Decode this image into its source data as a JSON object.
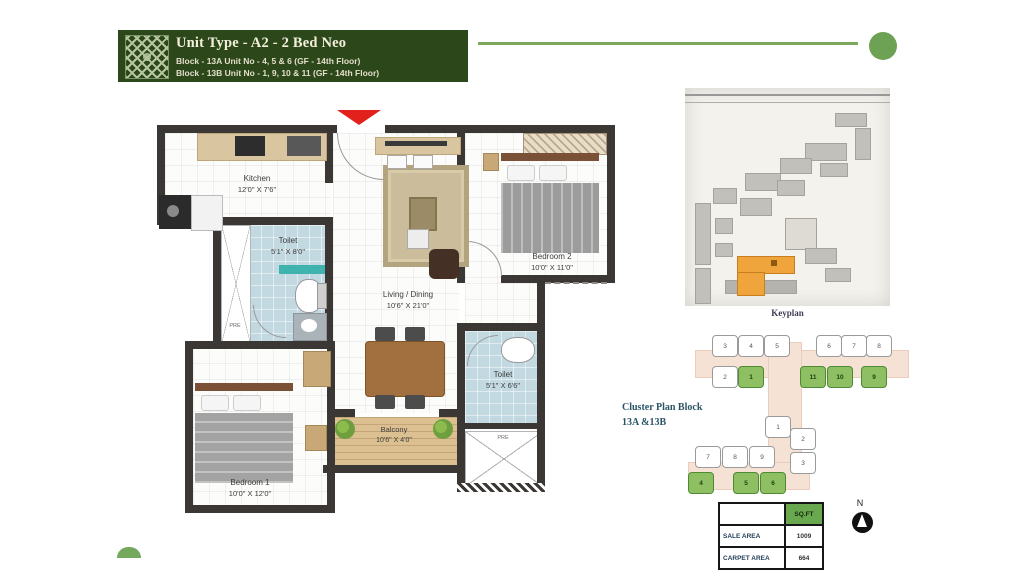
{
  "header": {
    "title": "Unit Type - A2 - 2 Bed Neo",
    "block_line1": "Block - 13A Unit No - 4, 5 & 6 (GF - 14th Floor)",
    "block_line2": "Block - 13B Unit No - 1, 9, 10 & 11 (GF - 14th Floor)"
  },
  "floorplan": {
    "kitchen": {
      "name": "Kitchen",
      "dims": "12'0\" X 7'6\""
    },
    "toilet1": {
      "name": "Toilet",
      "dims": "5'1\" X 8'0\""
    },
    "living": {
      "name": "Living / Dining",
      "dims": "10'6\" X 21'0\""
    },
    "bedroom2": {
      "name": "Bedroom 2",
      "dims": "10'0\" X 11'0\""
    },
    "toilet2": {
      "name": "Toilet",
      "dims": "5'1\" X 6'6\""
    },
    "bedroom1": {
      "name": "Bedroom 1",
      "dims": "10'0\" X 12'0\""
    },
    "balcony": {
      "name": "Balcony",
      "dims": "10'6\" X 4'0\""
    },
    "shaft1_label": "PRE",
    "shaft2_label": "PRE"
  },
  "keyplan": {
    "caption": "Keyplan"
  },
  "cluster": {
    "title_line1": "Cluster Plan Block",
    "title_line2": "13A &13B",
    "b13b_row1": [
      "3",
      "4",
      "5",
      "6",
      "7",
      "8"
    ],
    "b13b_row2": [
      "2",
      "1",
      "11",
      "10",
      "9"
    ],
    "b13a_col": [
      "1",
      "2",
      "3"
    ],
    "b13a_row": [
      "7",
      "8",
      "9"
    ],
    "b13a_green": [
      "4",
      "5",
      "6"
    ]
  },
  "area_table": {
    "col_header": "SQ.FT",
    "rows": [
      {
        "label": "SALE AREA",
        "value": "1009"
      },
      {
        "label": "CARPET AREA",
        "value": "664"
      }
    ]
  },
  "compass": {
    "label": "N"
  },
  "colors": {
    "banner_green": "#2c481a",
    "accent_green": "#74a85c",
    "cluster_highlight": "#8fbf63",
    "keyplan_highlight": "#f0a43c",
    "entry_arrow_red": "#e3211c",
    "table_header_green": "#6aa84f"
  }
}
